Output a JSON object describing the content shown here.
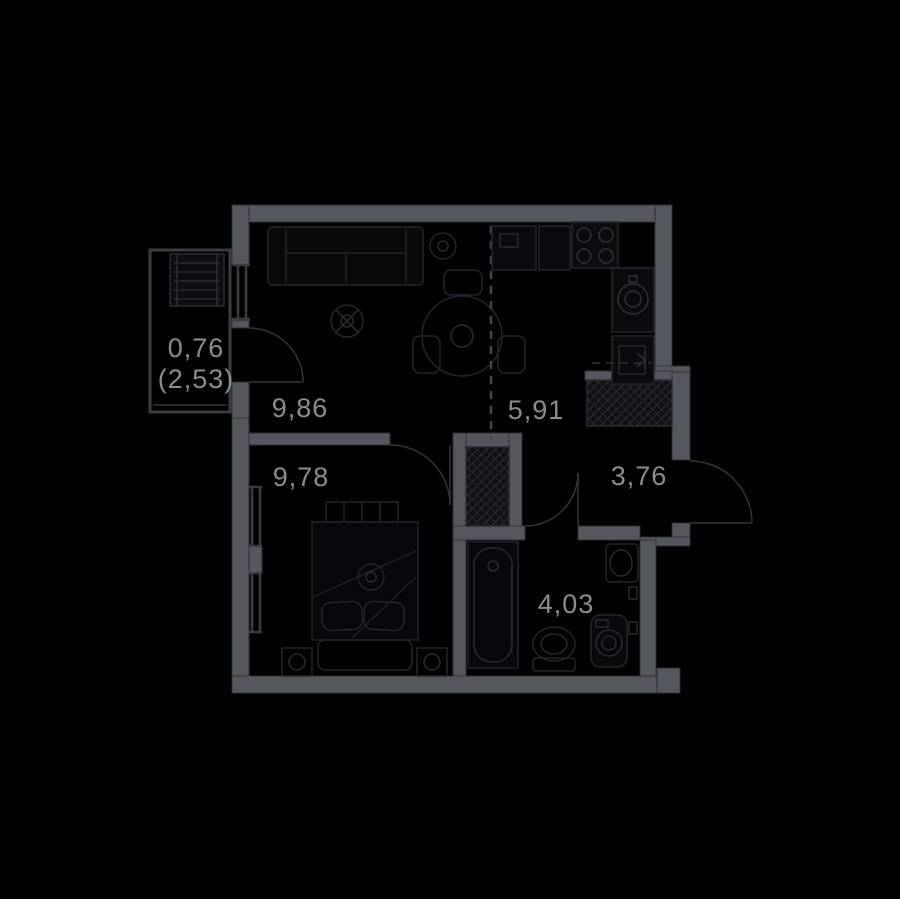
{
  "plan": {
    "type": "apartment-floor-plan",
    "colors": {
      "background": "#000000",
      "wall": "#55575f",
      "wall_edge": "#2e3036",
      "thin_wall": "#3a3c42",
      "furniture_line": "#24262c",
      "hatch_fill": "#101115",
      "hatch_line": "#2a2c32",
      "door_arc": "#33353b",
      "label": "#8a8c92"
    },
    "rooms": [
      {
        "id": "loggia",
        "area": "0,76",
        "area_note": "(2,53)"
      },
      {
        "id": "kitchen-living",
        "area": "9,86"
      },
      {
        "id": "kitchen-zone",
        "area": "5,91"
      },
      {
        "id": "bedroom",
        "area": "9,78"
      },
      {
        "id": "hallway",
        "area": "3,76"
      },
      {
        "id": "bathroom",
        "area": "4,03"
      }
    ]
  }
}
